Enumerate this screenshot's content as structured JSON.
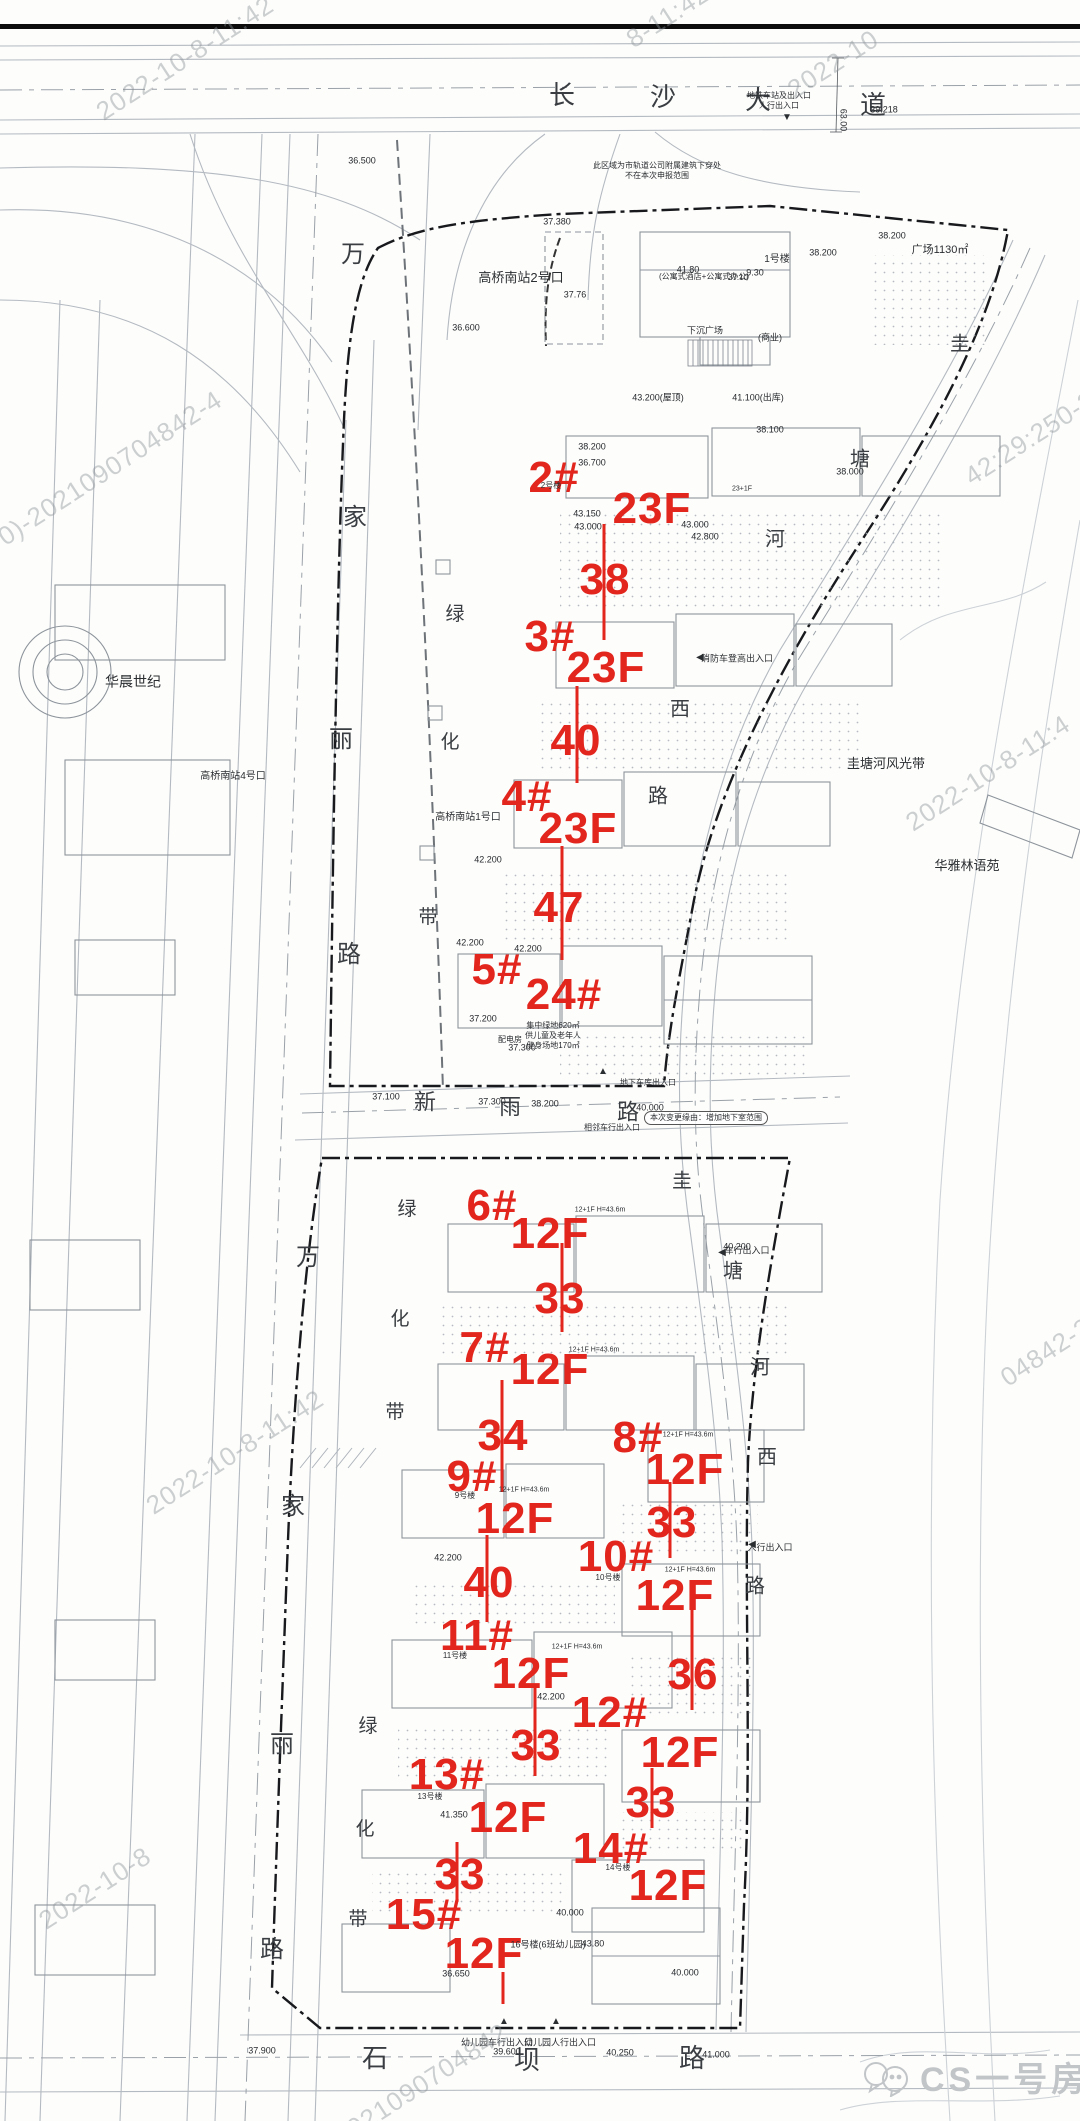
{
  "title": "住宅项目规划总平面图",
  "colors": {
    "annotation_red": "#e2251d",
    "road_gray": "#b4bac1",
    "boundary_dark": "#17191c",
    "watermark_gray": "#8b9196",
    "logo_gray": "#c2c5c8"
  },
  "logo": {
    "text": "CS一号房评",
    "icon": "chat-bubbles-icon"
  },
  "red_annotations": [
    {
      "text": "2#",
      "x": 554,
      "y": 478
    },
    {
      "text": "23F",
      "x": 652,
      "y": 509
    },
    {
      "text": "38",
      "x": 605,
      "y": 580
    },
    {
      "text": "3#",
      "x": 550,
      "y": 637
    },
    {
      "text": "23F",
      "x": 606,
      "y": 668
    },
    {
      "text": "40",
      "x": 576,
      "y": 741
    },
    {
      "text": "4#",
      "x": 527,
      "y": 797
    },
    {
      "text": "23F",
      "x": 578,
      "y": 829
    },
    {
      "text": "47",
      "x": 559,
      "y": 908
    },
    {
      "text": "5#",
      "x": 497,
      "y": 970
    },
    {
      "text": "24#",
      "x": 564,
      "y": 995
    },
    {
      "text": "6#",
      "x": 492,
      "y": 1206
    },
    {
      "text": "12F",
      "x": 550,
      "y": 1234
    },
    {
      "text": "33",
      "x": 560,
      "y": 1299
    },
    {
      "text": "7#",
      "x": 485,
      "y": 1348
    },
    {
      "text": "12F",
      "x": 550,
      "y": 1370
    },
    {
      "text": "34",
      "x": 503,
      "y": 1436
    },
    {
      "text": "8#",
      "x": 638,
      "y": 1438
    },
    {
      "text": "12F",
      "x": 685,
      "y": 1470
    },
    {
      "text": "33",
      "x": 672,
      "y": 1523
    },
    {
      "text": "9#",
      "x": 472,
      "y": 1477
    },
    {
      "text": "12F",
      "x": 515,
      "y": 1519
    },
    {
      "text": "40",
      "x": 489,
      "y": 1583
    },
    {
      "text": "10#",
      "x": 616,
      "y": 1557
    },
    {
      "text": "12F",
      "x": 675,
      "y": 1596
    },
    {
      "text": "36",
      "x": 693,
      "y": 1675
    },
    {
      "text": "11#",
      "x": 477,
      "y": 1636
    },
    {
      "text": "12F",
      "x": 531,
      "y": 1674
    },
    {
      "text": "33",
      "x": 536,
      "y": 1746
    },
    {
      "text": "12#",
      "x": 610,
      "y": 1713
    },
    {
      "text": "12F",
      "x": 680,
      "y": 1753
    },
    {
      "text": "33",
      "x": 651,
      "y": 1803
    },
    {
      "text": "13#",
      "x": 447,
      "y": 1775
    },
    {
      "text": "12F",
      "x": 508,
      "y": 1818
    },
    {
      "text": "33",
      "x": 460,
      "y": 1875
    },
    {
      "text": "14#",
      "x": 611,
      "y": 1849
    },
    {
      "text": "12F",
      "x": 668,
      "y": 1886
    },
    {
      "text": "15#",
      "x": 424,
      "y": 1915
    },
    {
      "text": "12F",
      "x": 484,
      "y": 1954
    }
  ],
  "red_lines": [
    {
      "x": 604,
      "y1": 524,
      "y2": 640
    },
    {
      "x": 577,
      "y1": 686,
      "y2": 783
    },
    {
      "x": 562,
      "y1": 846,
      "y2": 960
    },
    {
      "x": 562,
      "y1": 1243,
      "y2": 1332
    },
    {
      "x": 502,
      "y1": 1380,
      "y2": 1492
    },
    {
      "x": 487,
      "y1": 1535,
      "y2": 1622
    },
    {
      "x": 535,
      "y1": 1686,
      "y2": 1776
    },
    {
      "x": 670,
      "y1": 1482,
      "y2": 1558
    },
    {
      "x": 692,
      "y1": 1608,
      "y2": 1710
    },
    {
      "x": 652,
      "y1": 1768,
      "y2": 1828
    },
    {
      "x": 457,
      "y1": 1842,
      "y2": 1902
    },
    {
      "x": 503,
      "y1": 1972,
      "y2": 2004
    }
  ],
  "streets": [
    {
      "name": "长沙大道",
      "size": 26,
      "chars": [
        {
          "c": "长",
          "x": 562,
          "y": 95
        },
        {
          "c": "沙",
          "x": 663,
          "y": 97
        },
        {
          "c": "大",
          "x": 758,
          "y": 100
        },
        {
          "c": "道",
          "x": 873,
          "y": 105
        }
      ]
    },
    {
      "name": "万家丽路-北",
      "size": 24,
      "chars": [
        {
          "c": "万",
          "x": 353,
          "y": 255
        },
        {
          "c": "家",
          "x": 355,
          "y": 518
        },
        {
          "c": "丽",
          "x": 341,
          "y": 740
        },
        {
          "c": "路",
          "x": 349,
          "y": 955
        }
      ]
    },
    {
      "name": "万家丽路-南",
      "size": 24,
      "chars": [
        {
          "c": "万",
          "x": 308,
          "y": 1258
        },
        {
          "c": "家",
          "x": 293,
          "y": 1507
        },
        {
          "c": "丽",
          "x": 282,
          "y": 1745
        },
        {
          "c": "路",
          "x": 272,
          "y": 1950
        }
      ]
    },
    {
      "name": "绿化带-1",
      "size": 19,
      "chars": [
        {
          "c": "绿",
          "x": 455,
          "y": 615
        },
        {
          "c": "化",
          "x": 450,
          "y": 743
        },
        {
          "c": "带",
          "x": 428,
          "y": 918
        }
      ]
    },
    {
      "name": "绿化带-2",
      "size": 19,
      "chars": [
        {
          "c": "绿",
          "x": 407,
          "y": 1210
        },
        {
          "c": "化",
          "x": 400,
          "y": 1320
        },
        {
          "c": "带",
          "x": 395,
          "y": 1413
        }
      ]
    },
    {
      "name": "绿化带-3",
      "size": 19,
      "chars": [
        {
          "c": "绿",
          "x": 368,
          "y": 1727
        },
        {
          "c": "化",
          "x": 365,
          "y": 1830
        },
        {
          "c": "带",
          "x": 358,
          "y": 1920
        }
      ]
    },
    {
      "name": "新雨路",
      "size": 22,
      "chars": [
        {
          "c": "新",
          "x": 425,
          "y": 1102
        },
        {
          "c": "雨",
          "x": 510,
          "y": 1107
        },
        {
          "c": "路",
          "x": 628,
          "y": 1112
        }
      ]
    },
    {
      "name": "石坝路",
      "size": 26,
      "chars": [
        {
          "c": "石",
          "x": 375,
          "y": 2058
        },
        {
          "c": "坝",
          "x": 527,
          "y": 2060
        },
        {
          "c": "路",
          "x": 692,
          "y": 2058
        }
      ]
    },
    {
      "name": "圭塘河西路-北",
      "size": 20,
      "chars": [
        {
          "c": "圭",
          "x": 960,
          "y": 345
        },
        {
          "c": "塘",
          "x": 860,
          "y": 460
        },
        {
          "c": "河",
          "x": 775,
          "y": 540
        },
        {
          "c": "西",
          "x": 680,
          "y": 710
        },
        {
          "c": "路",
          "x": 658,
          "y": 797
        }
      ]
    },
    {
      "name": "圭塘河西路-南",
      "size": 20,
      "chars": [
        {
          "c": "圭",
          "x": 682,
          "y": 1182
        },
        {
          "c": "塘",
          "x": 733,
          "y": 1272
        },
        {
          "c": "河",
          "x": 760,
          "y": 1368
        },
        {
          "c": "西",
          "x": 767,
          "y": 1458
        },
        {
          "c": "路",
          "x": 755,
          "y": 1587
        }
      ]
    }
  ],
  "place_labels": [
    {
      "text": "高桥南站2号口",
      "x": 521,
      "y": 278,
      "size": 13
    },
    {
      "text": "高桥南站1号口",
      "x": 468,
      "y": 818,
      "size": 10
    },
    {
      "text": "高桥南站4号口",
      "x": 233,
      "y": 777,
      "size": 10
    },
    {
      "text": "华晨世纪",
      "x": 133,
      "y": 682,
      "size": 14
    },
    {
      "text": "圭塘河风光带",
      "x": 886,
      "y": 764,
      "size": 13
    },
    {
      "text": "华雅林语苑",
      "x": 967,
      "y": 866,
      "size": 13
    },
    {
      "text": "广场1130㎡",
      "x": 940,
      "y": 251,
      "size": 11
    },
    {
      "text": "1号楼",
      "x": 777,
      "y": 260,
      "size": 10
    },
    {
      "text": "(公寓式酒店+公寓式办公)",
      "x": 704,
      "y": 277,
      "size": 8
    },
    {
      "text": "37.10",
      "x": 738,
      "y": 278,
      "size": 8
    },
    {
      "text": "(商业)",
      "x": 770,
      "y": 338,
      "size": 9
    },
    {
      "text": "下沉广场",
      "x": 705,
      "y": 331,
      "size": 9
    },
    {
      "text": "此区域为市轨道公司附属建筑下穿处\n不在本次申报范围",
      "x": 657,
      "y": 171,
      "size": 8
    },
    {
      "text": "地铁车站及出入口\n人行出入口",
      "x": 779,
      "y": 101,
      "size": 8
    },
    {
      "text": "本次变更缘由：增加地下室范围",
      "x": 706,
      "y": 1118,
      "size": 8,
      "cls": "cloud"
    },
    {
      "text": "集中绿地620㎡\n供儿童及老年人\n健身场地170㎡",
      "x": 553,
      "y": 1036,
      "size": 8
    },
    {
      "text": "16号楼(6班幼儿园)",
      "x": 548,
      "y": 1945,
      "size": 9
    },
    {
      "text": "消防车登高出入口",
      "x": 737,
      "y": 659,
      "size": 9
    },
    {
      "text": "车行出入口",
      "x": 747,
      "y": 1251,
      "size": 9
    },
    {
      "text": "人行出入口",
      "x": 770,
      "y": 1548,
      "size": 9
    },
    {
      "text": "地下车库出入口",
      "x": 648,
      "y": 1083,
      "size": 8
    },
    {
      "text": "相邻车行出入口",
      "x": 612,
      "y": 1128,
      "size": 8
    },
    {
      "text": "幼儿园车行出入口",
      "x": 497,
      "y": 2043,
      "size": 9
    },
    {
      "text": "幼儿园人行出入口",
      "x": 560,
      "y": 2043,
      "size": 9
    },
    {
      "text": "2号楼",
      "x": 551,
      "y": 486,
      "size": 8
    },
    {
      "text": "9号楼",
      "x": 465,
      "y": 1496,
      "size": 8
    },
    {
      "text": "10号楼",
      "x": 608,
      "y": 1578,
      "size": 8
    },
    {
      "text": "11号楼",
      "x": 455,
      "y": 1656,
      "size": 8
    },
    {
      "text": "13号楼",
      "x": 430,
      "y": 1797,
      "size": 8
    },
    {
      "text": "14号楼",
      "x": 618,
      "y": 1868,
      "size": 8
    },
    {
      "text": "12+1F H=43.6m",
      "x": 600,
      "y": 1211,
      "size": 7
    },
    {
      "text": "12+1F H=43.6m",
      "x": 594,
      "y": 1351,
      "size": 7
    },
    {
      "text": "12+1F H=43.6m",
      "x": 688,
      "y": 1436,
      "size": 7
    },
    {
      "text": "12+1F H=43.6m",
      "x": 524,
      "y": 1491,
      "size": 7
    },
    {
      "text": "12+1F H=43.6m",
      "x": 690,
      "y": 1571,
      "size": 7
    },
    {
      "text": "12+1F H=43.6m",
      "x": 577,
      "y": 1648,
      "size": 7
    },
    {
      "text": "23+1F",
      "x": 742,
      "y": 490,
      "size": 7
    },
    {
      "text": "配电房",
      "x": 510,
      "y": 1040,
      "size": 8
    },
    {
      "text": "▼",
      "x": 787,
      "y": 118,
      "size": 10
    },
    {
      "text": "◀",
      "x": 700,
      "y": 658,
      "size": 10
    },
    {
      "text": "◀",
      "x": 722,
      "y": 1253,
      "size": 10
    },
    {
      "text": "◀",
      "x": 752,
      "y": 1545,
      "size": 10
    },
    {
      "text": "▲",
      "x": 603,
      "y": 1072,
      "size": 10
    },
    {
      "text": "▲",
      "x": 504,
      "y": 2022,
      "size": 10
    },
    {
      "text": "▲",
      "x": 556,
      "y": 2022,
      "size": 10
    },
    {
      "text": "63.00",
      "x": 843,
      "y": 120,
      "size": 9,
      "cls": "rot90"
    }
  ],
  "elevation_labels": [
    {
      "text": "36.500",
      "x": 362,
      "y": 161
    },
    {
      "text": "39.218",
      "x": 884,
      "y": 110
    },
    {
      "text": "37.380",
      "x": 557,
      "y": 222
    },
    {
      "text": "37.76",
      "x": 575,
      "y": 295
    },
    {
      "text": "36.600",
      "x": 466,
      "y": 328
    },
    {
      "text": "38.200",
      "x": 892,
      "y": 236
    },
    {
      "text": "38.200",
      "x": 823,
      "y": 253
    },
    {
      "text": "38.100",
      "x": 770,
      "y": 430
    },
    {
      "text": "43.200(屋顶)",
      "x": 658,
      "y": 398
    },
    {
      "text": "41.100(出库)",
      "x": 758,
      "y": 398
    },
    {
      "text": "38.200",
      "x": 592,
      "y": 447
    },
    {
      "text": "36.700",
      "x": 592,
      "y": 463
    },
    {
      "text": "43.150",
      "x": 587,
      "y": 514
    },
    {
      "text": "43.000",
      "x": 588,
      "y": 527
    },
    {
      "text": "43.000",
      "x": 695,
      "y": 525
    },
    {
      "text": "42.800",
      "x": 705,
      "y": 537
    },
    {
      "text": "41.80",
      "x": 688,
      "y": 270
    },
    {
      "text": "9.30",
      "x": 755,
      "y": 273
    },
    {
      "text": "42.200",
      "x": 488,
      "y": 860
    },
    {
      "text": "42.200",
      "x": 470,
      "y": 943
    },
    {
      "text": "42.200",
      "x": 528,
      "y": 949
    },
    {
      "text": "37.200",
      "x": 483,
      "y": 1019
    },
    {
      "text": "37.300",
      "x": 522,
      "y": 1048
    },
    {
      "text": "38.000",
      "x": 850,
      "y": 472
    },
    {
      "text": "37.100",
      "x": 386,
      "y": 1097
    },
    {
      "text": "37.300",
      "x": 492,
      "y": 1102
    },
    {
      "text": "38.200",
      "x": 545,
      "y": 1104
    },
    {
      "text": "40.000",
      "x": 650,
      "y": 1108
    },
    {
      "text": "40.200",
      "x": 737,
      "y": 1247
    },
    {
      "text": "42.200",
      "x": 448,
      "y": 1558
    },
    {
      "text": "42.200",
      "x": 551,
      "y": 1697
    },
    {
      "text": "41.350",
      "x": 454,
      "y": 1815
    },
    {
      "text": "36.650",
      "x": 456,
      "y": 1974
    },
    {
      "text": "40.000",
      "x": 570,
      "y": 1913
    },
    {
      "text": "43.80",
      "x": 593,
      "y": 1944
    },
    {
      "text": "40.000",
      "x": 685,
      "y": 1973
    },
    {
      "text": "39.600",
      "x": 507,
      "y": 2052
    },
    {
      "text": "40.250",
      "x": 620,
      "y": 2053
    },
    {
      "text": "41.000",
      "x": 716,
      "y": 2055
    },
    {
      "text": "37.900",
      "x": 262,
      "y": 2051
    }
  ],
  "watermarks": [
    {
      "text": "2022-10-8-11:42",
      "x": 185,
      "y": 58
    },
    {
      "text": "8-11:42",
      "x": 668,
      "y": 16
    },
    {
      "text": "2022-10",
      "x": 833,
      "y": 64
    },
    {
      "text": "0)-2021090704842-4",
      "x": 110,
      "y": 468
    },
    {
      "text": "42:29:250-2",
      "x": 1030,
      "y": 438
    },
    {
      "text": "2022-10-8-11:4",
      "x": 988,
      "y": 773
    },
    {
      "text": "2022-10-8-11:42",
      "x": 235,
      "y": 1452
    },
    {
      "text": "04842-2",
      "x": 1046,
      "y": 1352
    },
    {
      "text": "2022-10-8",
      "x": 95,
      "y": 1888
    },
    {
      "text": "50)-2021090704842",
      "x": 400,
      "y": 2098
    }
  ]
}
